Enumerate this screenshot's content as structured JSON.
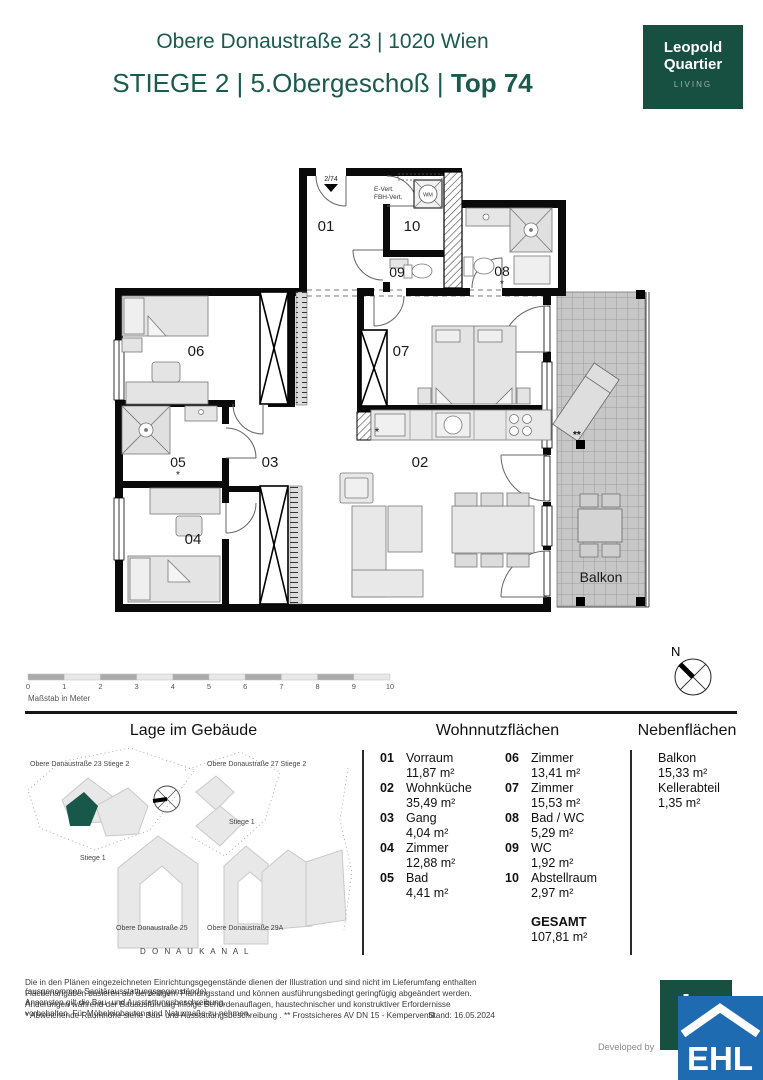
{
  "header": {
    "address": "Obere Donaustraße 23 | 1020 Wien",
    "unit_line": "STIEGE 2 | 5.Obergeschoß  |",
    "unit_top": " Top 74",
    "logo": {
      "line1": "Leopold",
      "line2": "Quartier",
      "line3": "LIVING"
    }
  },
  "plan": {
    "rooms": [
      {
        "id": "01"
      },
      {
        "id": "02"
      },
      {
        "id": "03"
      },
      {
        "id": "04"
      },
      {
        "id": "05"
      },
      {
        "id": "06"
      },
      {
        "id": "07"
      },
      {
        "id": "08"
      },
      {
        "id": "09"
      },
      {
        "id": "10"
      }
    ],
    "labels": {
      "balkon": "Balkon",
      "entrance": "2/74",
      "e_vert": "E-Vert.",
      "fbh_vert": "FBH-Vert.",
      "wm": "WM",
      "star": "*",
      "double_star": "**"
    }
  },
  "scale_bar": {
    "caption": "Maßstab in Meter",
    "ticks": [
      "0",
      "1",
      "2",
      "3",
      "4",
      "5",
      "6",
      "7",
      "8",
      "9",
      "10"
    ]
  },
  "compass": {
    "north": "N"
  },
  "site_plan": {
    "title": "Lage im Gebäude",
    "labels": {
      "bldg_23": "Obere Donaustraße 23 Stiege 2",
      "bldg_27": "Obere Donaustraße 27 Stiege 2",
      "stiege1_right": "Stiege 1",
      "stiege1_left": "Stiege 1",
      "bldg_25": "Obere Donaustraße 25",
      "bldg_29a": "Obere Donaustraße 29A",
      "canal": "D O N A U K A N A L"
    },
    "accent_color": "#17584a"
  },
  "living_areas": {
    "title": "Wohnnutzflächen",
    "left": [
      {
        "num": "01",
        "name": "Vorraum",
        "area": "11,87 m²"
      },
      {
        "num": "02",
        "name": "Wohnküche",
        "area": "35,49 m²"
      },
      {
        "num": "03",
        "name": "Gang",
        "area": "4,04 m²"
      },
      {
        "num": "04",
        "name": "Zimmer",
        "area": "12,88 m²"
      },
      {
        "num": "05",
        "name": "Bad",
        "area": "4,41 m²"
      }
    ],
    "right": [
      {
        "num": "06",
        "name": "Zimmer",
        "area": "13,41 m²"
      },
      {
        "num": "07",
        "name": "Zimmer",
        "area": "15,53 m²"
      },
      {
        "num": "08",
        "name": "Bad / WC",
        "area": "5,29 m²"
      },
      {
        "num": "09",
        "name": "WC",
        "area": "1,92 m²"
      },
      {
        "num": "10",
        "name": "Abstellraum",
        "area": "2,97 m²"
      }
    ],
    "total_label": "GESAMT",
    "total_area": "107,81 m²"
  },
  "side_areas": {
    "title": "Nebenflächen",
    "items": [
      {
        "name": "Balkon",
        "area": "15,33 m²"
      },
      {
        "name": "Kellerabteil",
        "area": "1,35 m²"
      }
    ]
  },
  "footer": {
    "line1": "Die in den Plänen eingezeichneten Einrichtungsgegenstände dienen der Illustration und sind nicht im Lieferumfang enthalten (ausgenommen Sanitärausstattungsgegenstände).",
    "line2": "Flächenangaben basieren auf derzeitigem Planungsstand und können ausführungsbedingt geringfügig abgeändert werden. Ansonsten gilt die Bau- und Ausstattungsbeschreibung.",
    "line3": "Änderungen während der Bauausführung infolge Behördenauflagen, haustechnischer und konstruktiver Erfordernisse vorbehalten. Für Möbeleinbauten sind Naturmaße zu nehmen.",
    "line4": "* Abweichende Raumhöhe siehe Bau- und Ausstattungsbeschreibung . ** Frostsicheres AV DN 15 - Kemperventil",
    "stand": "Stand: 16.05.2024",
    "developed_by": "Developed by",
    "ehl": "EHL"
  },
  "colors": {
    "brand_green": "#1a5b4d",
    "logo_green": "#174f40",
    "ehl_blue": "#1f6bb2"
  }
}
